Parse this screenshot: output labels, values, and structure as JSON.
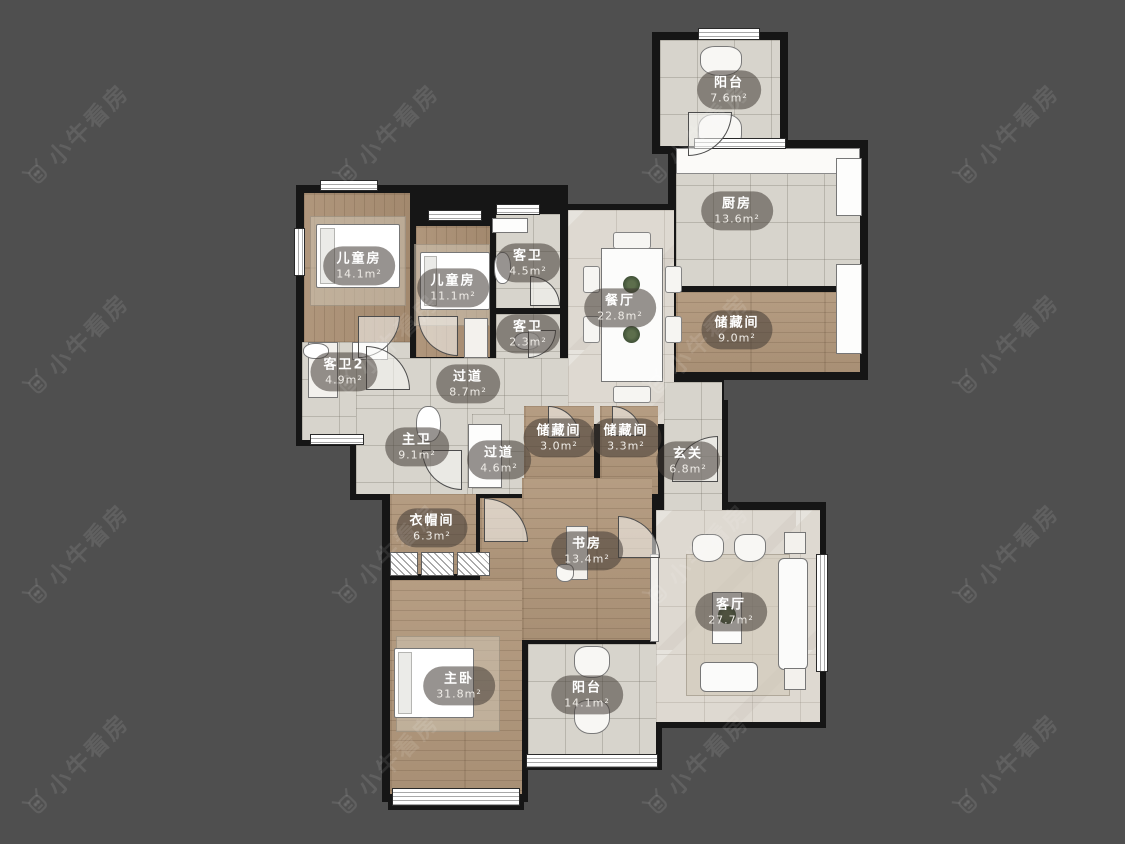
{
  "watermark": {
    "text": "小牛看房"
  },
  "floorplan": {
    "background": "#4f4f4f",
    "wall_color": "#161616",
    "rooms": [
      {
        "id": "balcony-top",
        "name": "阳台",
        "area": "7.6m²",
        "floor": "tile",
        "rect": [
          660,
          40,
          120,
          106
        ],
        "label": [
          729,
          90
        ]
      },
      {
        "id": "kitchen",
        "name": "厨房",
        "area": "13.6m²",
        "floor": "tile",
        "rect": [
          676,
          148,
          184,
          138
        ],
        "label": [
          737,
          211
        ]
      },
      {
        "id": "storage-9",
        "name": "储藏间",
        "area": "9.0m²",
        "floor": "wood",
        "rect": [
          676,
          292,
          184,
          80
        ],
        "label": [
          737,
          330
        ]
      },
      {
        "id": "dining",
        "name": "餐厅",
        "area": "22.8m²",
        "floor": "marble",
        "rect": [
          568,
          210,
          106,
          214
        ],
        "label": [
          620,
          308
        ]
      },
      {
        "id": "kids-room-1",
        "name": "儿童房",
        "area": "14.1m²",
        "floor": "wood-v",
        "rect": [
          304,
          193,
          106,
          164
        ],
        "label": [
          359,
          266
        ]
      },
      {
        "id": "kids-room-2",
        "name": "儿童房",
        "area": "11.1m²",
        "floor": "wood-v",
        "rect": [
          416,
          226,
          74,
          131
        ],
        "label": [
          453,
          288
        ]
      },
      {
        "id": "guest-bath-1",
        "name": "客卫",
        "area": "4.5m²",
        "floor": "tile",
        "rect": [
          496,
          214,
          64,
          94
        ],
        "label": [
          528,
          263
        ]
      },
      {
        "id": "guest-bath-2",
        "name": "客卫",
        "area": "2.3m²",
        "floor": "tile",
        "rect": [
          496,
          314,
          64,
          44
        ],
        "label": [
          528,
          334
        ]
      },
      {
        "id": "guest-bath-3",
        "name": "客卫2",
        "area": "4.9m²",
        "floor": "tile",
        "rect": [
          302,
          342,
          108,
          98
        ],
        "label": [
          344,
          372
        ]
      },
      {
        "id": "corridor-1",
        "name": "过道",
        "area": "8.7m²",
        "floor": "tile",
        "rect": [
          356,
          358,
          212,
          62
        ],
        "label": [
          468,
          384
        ]
      },
      {
        "id": "master-bath",
        "name": "主卫",
        "area": "9.1m²",
        "floor": "tile",
        "rect": [
          356,
          408,
          148,
          86
        ],
        "label": [
          417,
          447
        ]
      },
      {
        "id": "corridor-2",
        "name": "过道",
        "area": "4.6m²",
        "floor": "tile",
        "rect": [
          472,
          414,
          52,
          80
        ],
        "label": [
          499,
          460
        ]
      },
      {
        "id": "storage-30",
        "name": "储藏间",
        "area": "3.0m²",
        "floor": "wood",
        "rect": [
          524,
          406,
          70,
          88
        ],
        "label": [
          559,
          438
        ]
      },
      {
        "id": "storage-33",
        "name": "储藏间",
        "area": "3.3m²",
        "floor": "wood",
        "rect": [
          600,
          406,
          58,
          88
        ],
        "label": [
          626,
          438
        ]
      },
      {
        "id": "foyer",
        "name": "玄关",
        "area": "6.8m²",
        "floor": "tile",
        "rect": [
          664,
          382,
          58,
          130
        ],
        "label": [
          688,
          461
        ]
      },
      {
        "id": "cloakroom",
        "name": "衣帽间",
        "area": "6.3m²",
        "floor": "wood",
        "rect": [
          390,
          494,
          86,
          80
        ],
        "label": [
          432,
          528
        ]
      },
      {
        "id": "master-entry",
        "name": "",
        "area": "",
        "floor": "wood",
        "rect": [
          480,
          498,
          42,
          92
        ],
        "label": null
      },
      {
        "id": "study",
        "name": "书房",
        "area": "13.4m²",
        "floor": "wood",
        "rect": [
          522,
          478,
          130,
          162
        ],
        "label": [
          587,
          551
        ]
      },
      {
        "id": "living",
        "name": "客厅",
        "area": "27.7m²",
        "floor": "marble",
        "rect": [
          656,
          510,
          164,
          212
        ],
        "label": [
          731,
          612
        ]
      },
      {
        "id": "master-bedroom",
        "name": "主卧",
        "area": "31.8m²",
        "floor": "wood",
        "rect": [
          390,
          580,
          132,
          214
        ],
        "label": [
          459,
          686
        ]
      },
      {
        "id": "balcony-bottom",
        "name": "阳台",
        "area": "14.1m²",
        "floor": "tile",
        "rect": [
          528,
          644,
          128,
          120
        ],
        "label": [
          587,
          695
        ]
      }
    ],
    "walls": [
      [
        652,
        32,
        136,
        122
      ],
      [
        668,
        140,
        200,
        240
      ],
      [
        296,
        185,
        272,
        180
      ],
      [
        296,
        336,
        122,
        110
      ],
      [
        522,
        204,
        202,
        226
      ],
      [
        350,
        352,
        218,
        74
      ],
      [
        350,
        402,
        162,
        98
      ],
      [
        466,
        400,
        262,
        108
      ],
      [
        382,
        470,
        146,
        332
      ],
      [
        516,
        470,
        142,
        178
      ],
      [
        520,
        636,
        142,
        134
      ],
      [
        648,
        502,
        178,
        226
      ],
      [
        388,
        784,
        136,
        26
      ],
      [
        474,
        492,
        54,
        104
      ]
    ],
    "windows": [
      [
        698,
        28,
        62,
        12
      ],
      [
        694,
        138,
        92,
        11
      ],
      [
        320,
        180,
        58,
        11
      ],
      [
        428,
        210,
        54,
        11
      ],
      [
        496,
        204,
        44,
        11
      ],
      [
        294,
        228,
        11,
        48
      ],
      [
        310,
        434,
        54,
        11
      ],
      [
        816,
        554,
        12,
        118
      ],
      [
        392,
        788,
        128,
        18
      ],
      [
        526,
        754,
        132,
        14
      ]
    ],
    "doors": [
      {
        "x": 672,
        "y": 436,
        "r": 46,
        "corner": "tl"
      },
      {
        "x": 358,
        "y": 316,
        "r": 42,
        "corner": "br"
      },
      {
        "x": 418,
        "y": 316,
        "r": 40,
        "corner": "bl"
      },
      {
        "x": 530,
        "y": 276,
        "r": 30,
        "corner": "tr"
      },
      {
        "x": 528,
        "y": 330,
        "r": 28,
        "corner": "br"
      },
      {
        "x": 366,
        "y": 346,
        "r": 44,
        "corner": "tr"
      },
      {
        "x": 422,
        "y": 450,
        "r": 40,
        "corner": "bl"
      },
      {
        "x": 484,
        "y": 498,
        "r": 44,
        "corner": "tr"
      },
      {
        "x": 548,
        "y": 406,
        "r": 32,
        "corner": "tr"
      },
      {
        "x": 612,
        "y": 406,
        "r": 30,
        "corner": "tr"
      },
      {
        "x": 688,
        "y": 112,
        "r": 44,
        "corner": "br"
      },
      {
        "x": 618,
        "y": 516,
        "r": 42,
        "corner": "tr"
      }
    ],
    "furniture": [
      {
        "type": "table",
        "rect": [
          601,
          248,
          62,
          134
        ],
        "name": "dining-table"
      },
      {
        "type": "chair",
        "rect": [
          583,
          266,
          17,
          27
        ],
        "name": "dining-chair"
      },
      {
        "type": "chair",
        "rect": [
          583,
          316,
          17,
          27
        ],
        "name": "dining-chair"
      },
      {
        "type": "chair",
        "rect": [
          665,
          266,
          17,
          27
        ],
        "name": "dining-chair"
      },
      {
        "type": "chair",
        "rect": [
          665,
          316,
          17,
          27
        ],
        "name": "dining-chair"
      },
      {
        "type": "chair",
        "rect": [
          613,
          232,
          38,
          17
        ],
        "name": "dining-chair"
      },
      {
        "type": "chair",
        "rect": [
          613,
          386,
          38,
          17
        ],
        "name": "dining-chair"
      },
      {
        "type": "plant",
        "rect": [
          623,
          276,
          17,
          17
        ],
        "name": "table-plant"
      },
      {
        "type": "plant",
        "rect": [
          623,
          326,
          17,
          17
        ],
        "name": "table-plant"
      },
      {
        "type": "rug",
        "rect": [
          310,
          216,
          96,
          90
        ],
        "name": "kids1-rug"
      },
      {
        "type": "bed",
        "rect": [
          316,
          224,
          84,
          64
        ],
        "name": "kids1-bed"
      },
      {
        "type": "cabinet",
        "rect": [
          308,
          342,
          30,
          56
        ],
        "name": "kids1-desk"
      },
      {
        "type": "rug",
        "rect": [
          414,
          244,
          76,
          82
        ],
        "name": "kids2-rug"
      },
      {
        "type": "bed",
        "rect": [
          420,
          252,
          70,
          58
        ],
        "name": "kids2-bed"
      },
      {
        "type": "cabinet",
        "rect": [
          464,
          318,
          24,
          40
        ],
        "name": "kids2-desk"
      },
      {
        "type": "rug",
        "rect": [
          396,
          636,
          104,
          96
        ],
        "name": "master-rug"
      },
      {
        "type": "bed",
        "rect": [
          394,
          648,
          80,
          70
        ],
        "name": "master-bed"
      },
      {
        "type": "rug",
        "rect": [
          686,
          554,
          104,
          142
        ],
        "name": "living-rug"
      },
      {
        "type": "chair-r",
        "rect": [
          692,
          534,
          32,
          28
        ],
        "name": "armchair"
      },
      {
        "type": "chair-r",
        "rect": [
          734,
          534,
          32,
          28
        ],
        "name": "armchair"
      },
      {
        "type": "sofa",
        "rect": [
          778,
          558,
          30,
          112
        ],
        "name": "sofa-long"
      },
      {
        "type": "sofa",
        "rect": [
          700,
          662,
          58,
          30
        ],
        "name": "sofa-small"
      },
      {
        "type": "table",
        "rect": [
          712,
          592,
          30,
          52
        ],
        "name": "coffee-table"
      },
      {
        "type": "plant",
        "rect": [
          718,
          606,
          18,
          18
        ],
        "name": "coffee-plant"
      },
      {
        "type": "cabinet",
        "rect": [
          784,
          532,
          22,
          22
        ],
        "name": "side-table"
      },
      {
        "type": "cabinet",
        "rect": [
          784,
          668,
          22,
          22
        ],
        "name": "side-table"
      },
      {
        "type": "cabinet",
        "rect": [
          650,
          554,
          9,
          88
        ],
        "name": "tv-cabinet"
      },
      {
        "type": "cabinet",
        "rect": [
          566,
          526,
          22,
          54
        ],
        "name": "study-desk"
      },
      {
        "type": "chair-r",
        "rect": [
          556,
          564,
          18,
          18
        ],
        "name": "study-chair"
      },
      {
        "type": "wardrobe",
        "rect": [
          390,
          552,
          28,
          24
        ],
        "name": "wardrobe"
      },
      {
        "type": "wardrobe",
        "rect": [
          421,
          552,
          33,
          24
        ],
        "name": "wardrobe"
      },
      {
        "type": "wardrobe",
        "rect": [
          457,
          552,
          33,
          24
        ],
        "name": "wardrobe"
      },
      {
        "type": "chair-r",
        "rect": [
          574,
          646,
          36,
          32
        ],
        "name": "balcony-chair"
      },
      {
        "type": "chair-r",
        "rect": [
          574,
          700,
          36,
          34
        ],
        "name": "balcony-chair"
      },
      {
        "type": "chair-r",
        "rect": [
          700,
          46,
          42,
          30
        ],
        "name": "balcony-seat"
      },
      {
        "type": "chair-r",
        "rect": [
          698,
          114,
          44,
          38
        ],
        "name": "balcony-seat"
      },
      {
        "type": "counter",
        "rect": [
          676,
          148,
          184,
          26
        ],
        "name": "kitchen-counter"
      },
      {
        "type": "appliance",
        "rect": [
          836,
          158,
          26,
          58
        ],
        "name": "fridge"
      },
      {
        "type": "appliance",
        "rect": [
          836,
          264,
          26,
          90
        ],
        "name": "kitchen-cabinet"
      },
      {
        "type": "appliance",
        "rect": [
          492,
          218,
          36,
          15
        ],
        "name": "bath-sink"
      },
      {
        "type": "toilet",
        "rect": [
          494,
          252,
          17,
          32
        ],
        "name": "toilet"
      },
      {
        "type": "toilet",
        "rect": [
          514,
          332,
          26,
          18
        ],
        "name": "toilet"
      },
      {
        "type": "toilet",
        "rect": [
          303,
          343,
          26,
          16
        ],
        "name": "toilet"
      },
      {
        "type": "appliance",
        "rect": [
          352,
          342,
          36,
          18
        ],
        "name": "bath-sink"
      },
      {
        "type": "toilet",
        "rect": [
          416,
          406,
          25,
          36
        ],
        "name": "toilet"
      },
      {
        "type": "appliance",
        "rect": [
          468,
          424,
          34,
          64
        ],
        "name": "double-vanity"
      }
    ],
    "watermark_grid": {
      "cols": [
        75,
        385,
        695,
        1005
      ],
      "rows": [
        135,
        345,
        555,
        765
      ]
    }
  }
}
